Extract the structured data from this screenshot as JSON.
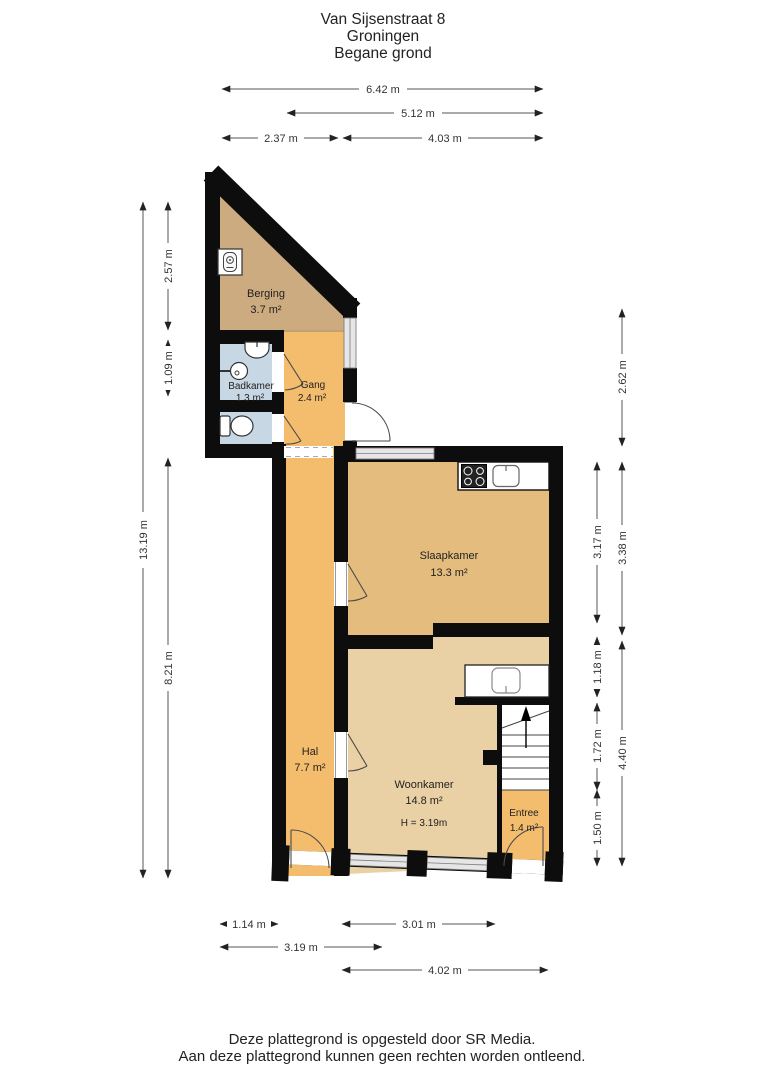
{
  "title": {
    "line1": "Van Sijsenstraat 8",
    "line2": "Groningen",
    "line3": "Begane grond"
  },
  "footer": {
    "line1": "Deze plattegrond is opgesteld door SR Media.",
    "line2": "Aan deze plattegrond kunnen geen rechten worden ontleend."
  },
  "rooms": {
    "berging": {
      "name": "Berging",
      "area": "3.7 m²"
    },
    "badkamer": {
      "name": "Badkamer",
      "area": "1.3 m²"
    },
    "gang": {
      "name": "Gang",
      "area": "2.4 m²"
    },
    "slaapkamer": {
      "name": "Slaapkamer",
      "area": "13.3 m²"
    },
    "hal": {
      "name": "Hal",
      "area": "7.7 m²"
    },
    "woonkamer": {
      "name": "Woonkamer",
      "area": "14.8 m²",
      "height": "H = 3.19m"
    },
    "entree": {
      "name": "Entree",
      "area": "1.4 m²"
    }
  },
  "dimensions": {
    "top": [
      "6.42 m",
      "5.12 m",
      "2.37 m",
      "4.03 m"
    ],
    "left": [
      "13.19 m",
      "2.57 m",
      "1.09 m",
      "8.21 m"
    ],
    "right": [
      "2.62 m",
      "3.17 m",
      "3.38 m",
      "1.18 m",
      "1.72 m",
      "4.40 m",
      "1.50 m"
    ],
    "bottom": [
      "1.14 m",
      "3.01 m",
      "3.19 m",
      "4.02 m"
    ]
  },
  "colors": {
    "wall": "#0d0d0d",
    "storage_tan": "#cdab80",
    "circulation_orange": "#f4bd6d",
    "bedroom_tan": "#e3bc7e",
    "living_beige": "#ead1a5",
    "bathroom_blue": "#c7d7e4",
    "window_grey": "#e6e6e6"
  },
  "icons": {
    "boiler": "boiler-icon",
    "shower": "shower-icon",
    "washbasin": "washbasin-icon",
    "toilet": "toilet-icon",
    "stove": "stove-icon",
    "sink": "sink-icon",
    "stairs": "stairs-up-arrow-icon"
  }
}
